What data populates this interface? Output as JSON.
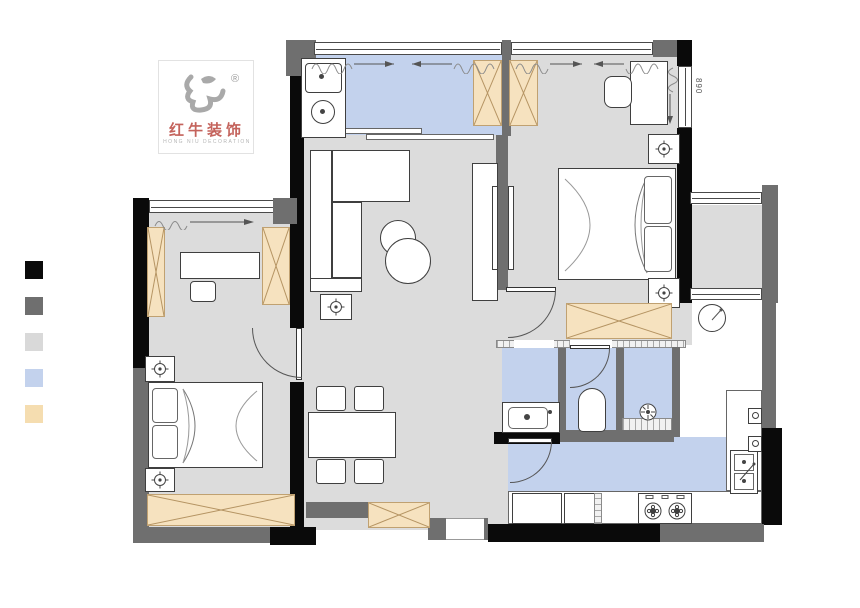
{
  "logo": {
    "brand_cn": "红牛装饰",
    "brand_en": "HONG NIU DECORATION",
    "registered": "®"
  },
  "plan": {
    "dimension_label": "890"
  },
  "legend": {
    "items": [
      {
        "name": "load-bearing-wall",
        "color": "#0a0a0a"
      },
      {
        "name": "new-wall",
        "color": "#6f6f6f"
      },
      {
        "name": "floor-area",
        "color": "#d9d9d9"
      },
      {
        "name": "water-area-floor",
        "color": "#c3d2ed"
      },
      {
        "name": "custom-furniture",
        "color": "#f5ddb0"
      }
    ]
  },
  "palette": {
    "wall-black": "#0a0a0a",
    "wall-gray": "#6f6f6f",
    "floor-gray": "#dcdcdc",
    "floor-blue": "#c3d2ed",
    "cream": "#f6e2bf",
    "brand-red": "#c4635c"
  }
}
